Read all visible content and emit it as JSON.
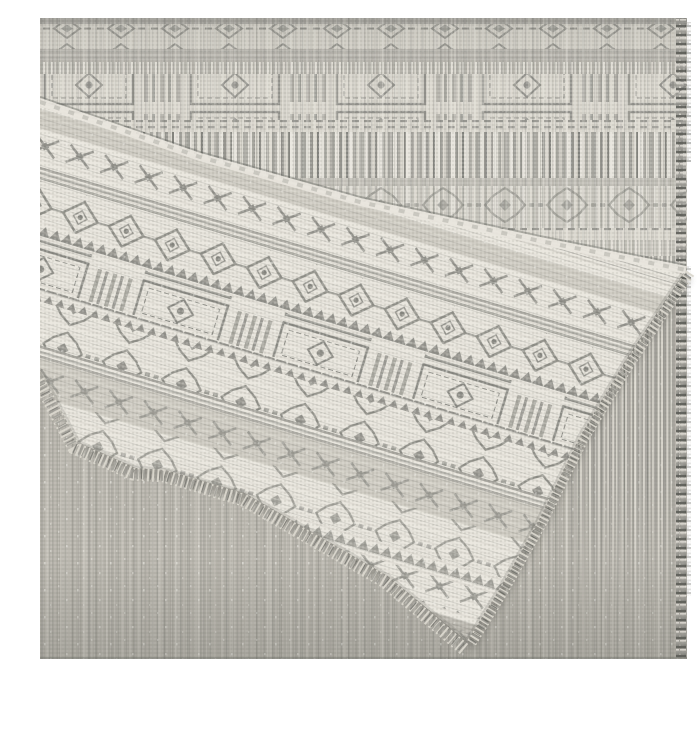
{
  "scene": {
    "kind": "product-photograph",
    "alt": "Gray and cream flatweave area rug with geometric tribal diamond-eye border pattern, one corner folded over diagonally to show the reverse side, fringed serged edges, photographed on a white background",
    "objects": [
      "area-rug",
      "folded-corner-flap",
      "fringe",
      "serged-edge"
    ],
    "background": "white"
  },
  "rug": {
    "style": "geometric tribal flatweave",
    "motifs": [
      "diamond-eye medallion",
      "zigzag triangles",
      "stepped diamonds",
      "vertical bar bands",
      "stripe bands"
    ],
    "texture": "melange basket weave with sparkle flecks",
    "front_face": "crisp cream and gray pattern (visible on folded flap)",
    "back_face": "washed-out faded pattern with vertical striations"
  },
  "palette": {
    "white": "#ffffff",
    "cream": "#e9e6de",
    "bandCream": "#dad7ce",
    "lightGreige": "#cfccc3",
    "greige": "#b7b4ac",
    "midGray": "#9b9a93",
    "slate": "#85857f",
    "darkGray": "#6b6c67",
    "charcoal": "#54554f",
    "sparkle": "#f6f5f0",
    "shadow": "#3c3d39"
  }
}
